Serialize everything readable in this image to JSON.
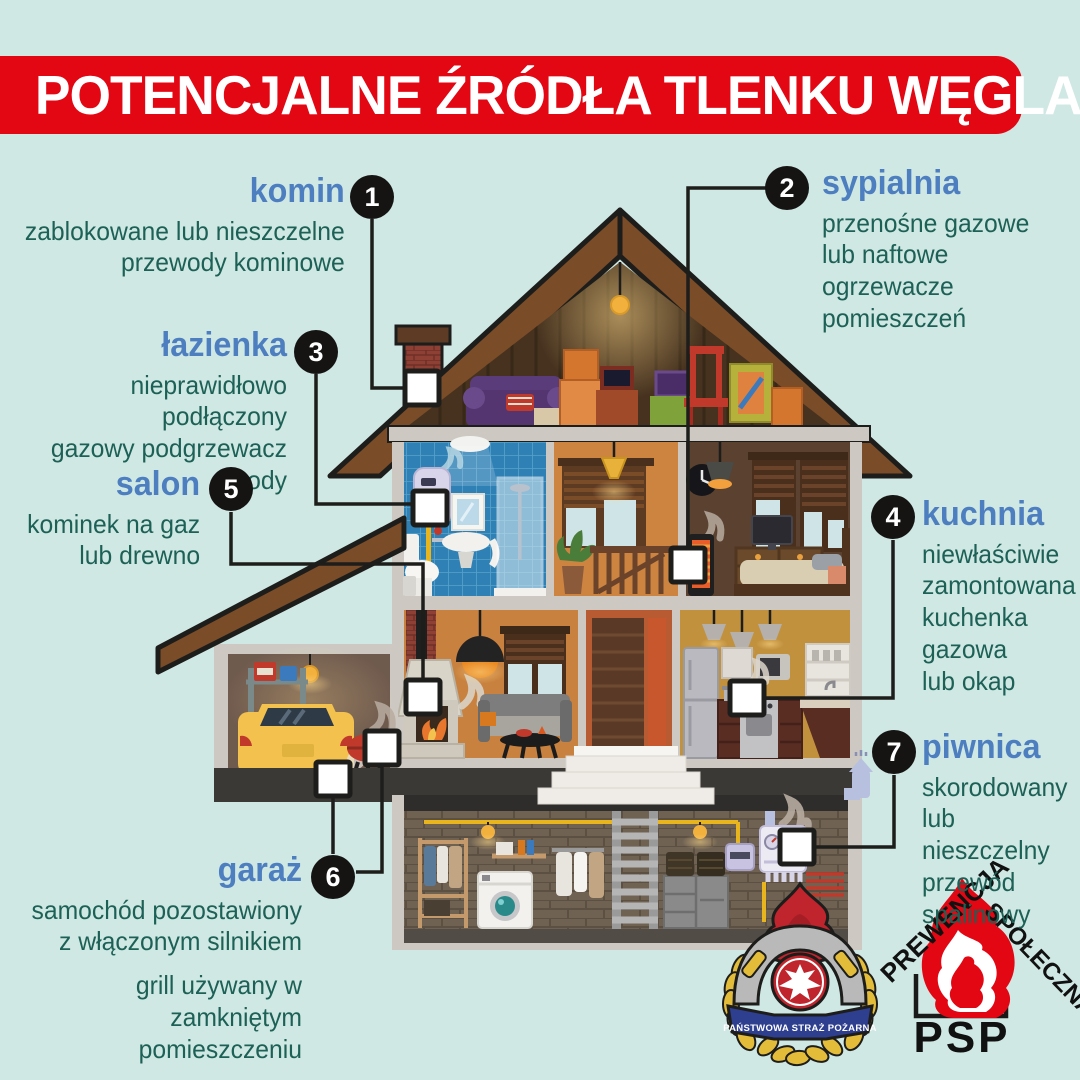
{
  "title_banner": {
    "text": "POTENCJALNE ŹRÓDŁA TLENKU WĘGLA"
  },
  "colors": {
    "background": "#cfe8e3",
    "banner_red": "#e30613",
    "room_label_blue": "#4d7ec0",
    "description_teal": "#1d6156",
    "line_black": "#1d1d1b",
    "roof_brown": "#7a4c28",
    "bathroom_blue": "#2f81b5"
  },
  "labels": [
    {
      "num": "1",
      "name": "komin",
      "desc": "zablokowane lub nieszczelne\nprzewody kominowe"
    },
    {
      "num": "2",
      "name": "sypialnia",
      "desc": "przenośne gazowe\nlub naftowe ogrzewacze\npomieszczeń"
    },
    {
      "num": "3",
      "name": "łazienka",
      "desc": "nieprawidłowo podłączony\ngazowy podgrzewacz wody"
    },
    {
      "num": "4",
      "name": "kuchnia",
      "desc": "niewłaściwie\nzamontowana\nkuchenka\ngazowa\nlub okap"
    },
    {
      "num": "5",
      "name": "salon",
      "desc": "kominek na gaz\nlub drewno"
    },
    {
      "num": "6",
      "name": "garaż",
      "desc": "samochód pozostawiony\nz włączonym silnikiem",
      "desc2": "grill używany w zamkniętym\npomieszczeniu"
    },
    {
      "num": "7",
      "name": "piwnica",
      "desc": "skorodowany\nlub nieszczelny\nprzewód\nspalinowy"
    }
  ],
  "logos": {
    "psp_badge": {
      "ribbon_text": "PAŃSTWOWA STRAŻ POŻARNA"
    },
    "psp_prevention": {
      "arc_left": "PREWENCJA",
      "arc_right": "SPOŁECZNA",
      "abbr": "PSP"
    }
  }
}
